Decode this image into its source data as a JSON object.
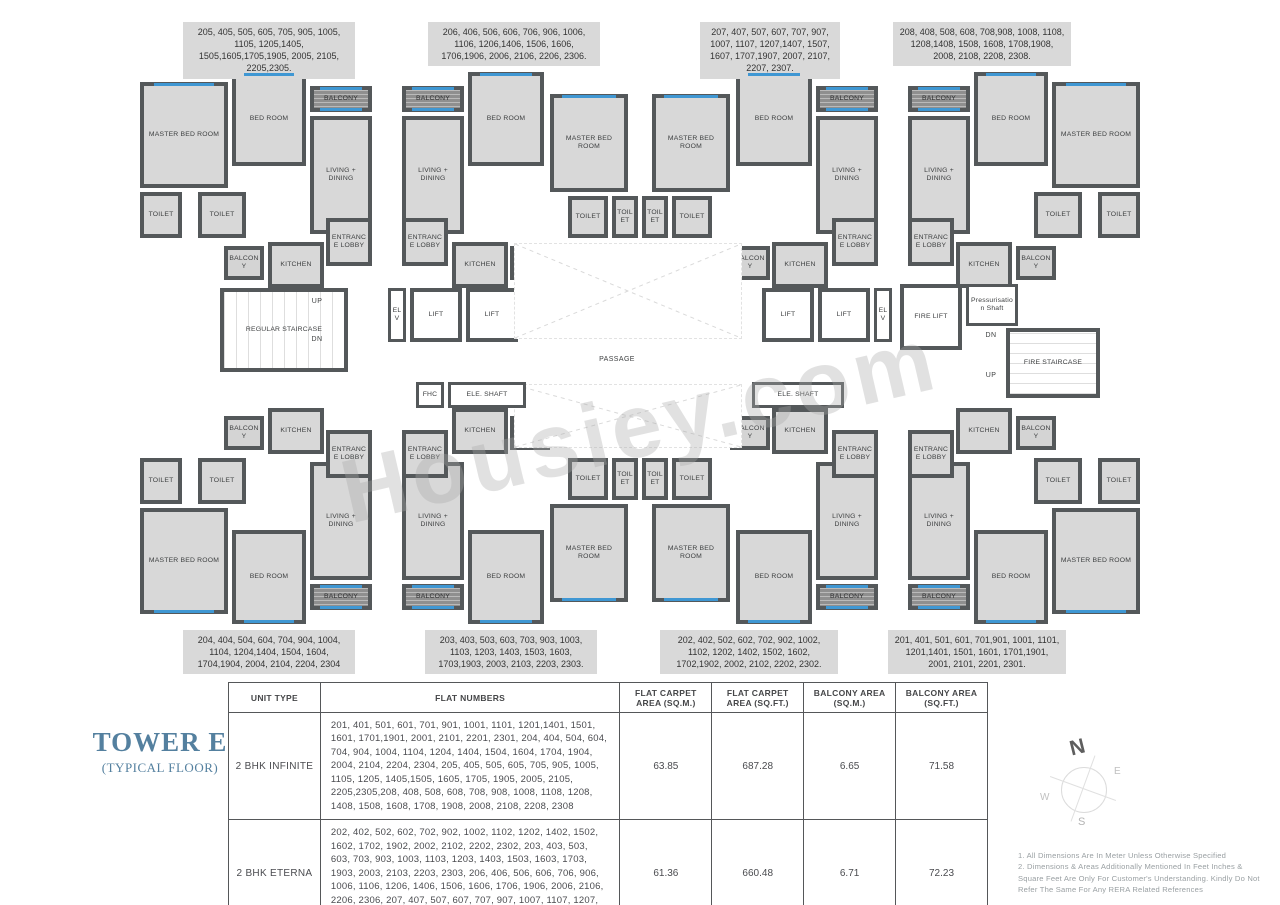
{
  "title": {
    "tower": "TOWER E",
    "floor": "(TYPICAL FLOOR)"
  },
  "watermark": "Housiey.com",
  "flat_labels": {
    "top": [
      "205, 405, 505, 605, 705, 905, 1005, 1105, 1205,1405, 1505,1605,1705,1905, 2005, 2105, 2205,2305.",
      "206, 406, 506, 606, 706, 906, 1006, 1106, 1206,1406, 1506, 1606, 1706,1906, 2006, 2106, 2206, 2306.",
      "207, 407, 507, 607, 707, 907, 1007, 1107, 1207,1407, 1507, 1607, 1707,1907, 2007, 2107, 2207, 2307.",
      "208, 408, 508, 608, 708,908, 1008, 1108, 1208,1408, 1508, 1608, 1708,1908, 2008, 2108, 2208, 2308."
    ],
    "bottom": [
      "204, 404, 504, 604, 704, 904, 1004, 1104, 1204,1404, 1504, 1604, 1704,1904, 2004, 2104, 2204, 2304",
      "203, 403, 503, 603, 703, 903, 1003, 1103, 1203, 1403, 1503, 1603, 1703,1903, 2003, 2103, 2203, 2303.",
      "202, 402, 502, 602, 702, 902, 1002, 1102, 1202, 1402, 1502, 1602, 1702,1902, 2002, 2102, 2202, 2302.",
      "201, 401, 501, 601, 701,901, 1001, 1101, 1201,1401, 1501, 1601, 1701,1901, 2001, 2101, 2201, 2301."
    ]
  },
  "table": {
    "headers": [
      "UNIT TYPE",
      "FLAT NUMBERS",
      "FLAT CARPET AREA (SQ.M.)",
      "FLAT CARPET AREA (SQ.FT.)",
      "BALCONY AREA (SQ.M.)",
      "BALCONY AREA (SQ.FT.)"
    ],
    "rows": [
      {
        "unit_type": "2 BHK INFINITE",
        "flat_numbers": "201, 401, 501, 601, 701, 901, 1001, 1101, 1201,1401, 1501, 1601, 1701,1901, 2001, 2101, 2201, 2301, 204, 404, 504, 604, 704, 904, 1004, 1104, 1204, 1404, 1504, 1604, 1704, 1904, 2004, 2104, 2204, 2304, 205, 405, 505, 605, 705, 905, 1005, 1105, 1205, 1405,1505, 1605, 1705, 1905, 2005, 2105, 2205,2305,208, 408, 508, 608, 708, 908, 1008, 1108, 1208, 1408, 1508, 1608, 1708, 1908, 2008, 2108, 2208, 2308",
        "carpet_sqm": "63.85",
        "carpet_sqft": "687.28",
        "balcony_sqm": "6.65",
        "balcony_sqft": "71.58"
      },
      {
        "unit_type": "2 BHK ETERNA",
        "flat_numbers": "202, 402, 502, 602, 702, 902, 1002, 1102, 1202, 1402, 1502, 1602, 1702, 1902, 2002, 2102, 2202, 2302, 203, 403, 503, 603, 703, 903, 1003, 1103, 1203, 1403, 1503, 1603, 1703, 1903, 2003, 2103, 2203, 2303, 206, 406, 506, 606, 706, 906, 1006, 1106, 1206, 1406, 1506, 1606, 1706, 1906, 2006, 2106, 2206, 2306, 207, 407, 507, 607, 707, 907, 1007, 1107, 1207, 1407, 1507, 1607, 1707, 1907, 2007, 2107, 2207, 2307.",
        "carpet_sqm": "61.36",
        "carpet_sqft": "660.48",
        "balcony_sqm": "6.71",
        "balcony_sqft": "72.23"
      }
    ]
  },
  "notes": [
    "1.  All Dimensions Are In Meter Unless Otherwise Specified",
    "2.  Dimensions & Areas Additionally Mentioned In Feet Inches & Square Feet Are Only For Customer's Understanding. Kindly Do Not Refer The Same For Any RERA Related References"
  ],
  "compass": {
    "n": "N",
    "e": "E",
    "w": "W",
    "s": "S"
  },
  "colors": {
    "wall": "#54585a",
    "room_fill": "#d8d8d8",
    "balcony_fill": "#8f8f8f",
    "window_blue": "#3f97d3",
    "label_box": "#d9d9d9",
    "title_blue": "#54809f"
  },
  "plan": {
    "half_rooms": [
      {
        "t": "room",
        "x": 0,
        "y": 12,
        "w": 88,
        "h": 106,
        "l": "MASTER BED ROOM",
        "win": "top"
      },
      {
        "t": "room",
        "x": 92,
        "y": 2,
        "w": 74,
        "h": 94,
        "l": "BED ROOM",
        "win": "top"
      },
      {
        "t": "balcony",
        "x": 170,
        "y": 16,
        "w": 62,
        "h": 26,
        "l": "BALCONY"
      },
      {
        "t": "room",
        "x": 170,
        "y": 46,
        "w": 62,
        "h": 118,
        "l": "LIVING + DINING"
      },
      {
        "t": "room",
        "x": 0,
        "y": 122,
        "w": 42,
        "h": 46,
        "l": "TOILET"
      },
      {
        "t": "room",
        "x": 58,
        "y": 122,
        "w": 48,
        "h": 46,
        "l": "TOILET"
      },
      {
        "t": "balcony2",
        "x": 84,
        "y": 176,
        "w": 40,
        "h": 34,
        "l": "BALCONY"
      },
      {
        "t": "room",
        "x": 128,
        "y": 172,
        "w": 56,
        "h": 46,
        "l": "KITCHEN"
      },
      {
        "t": "room",
        "x": 186,
        "y": 148,
        "w": 46,
        "h": 48,
        "l": "ENTRANCE LOBBY"
      },
      {
        "t": "balcony",
        "x": 262,
        "y": 16,
        "w": 62,
        "h": 26,
        "l": "BALCONY"
      },
      {
        "t": "room",
        "x": 262,
        "y": 46,
        "w": 62,
        "h": 118,
        "l": "LIVING + DINING"
      },
      {
        "t": "room",
        "x": 262,
        "y": 148,
        "w": 46,
        "h": 48,
        "l": "ENTRANCE LOBBY"
      },
      {
        "t": "room",
        "x": 312,
        "y": 172,
        "w": 56,
        "h": 46,
        "l": "KITCHEN"
      },
      {
        "t": "balcony2",
        "x": 370,
        "y": 176,
        "w": 40,
        "h": 34,
        "l": "BALCONY"
      },
      {
        "t": "room",
        "x": 328,
        "y": 2,
        "w": 76,
        "h": 94,
        "l": "BED ROOM",
        "win": "top"
      },
      {
        "t": "room",
        "x": 410,
        "y": 24,
        "w": 78,
        "h": 98,
        "l": "MASTER BED ROOM",
        "win": "top"
      },
      {
        "t": "room",
        "x": 428,
        "y": 126,
        "w": 40,
        "h": 42,
        "l": "TOILET"
      },
      {
        "t": "room",
        "x": 472,
        "y": 126,
        "w": 26,
        "h": 42,
        "l": "TOILET"
      },
      {
        "t": "balcony",
        "x": 676,
        "y": 16,
        "w": 62,
        "h": 26,
        "l": "BALCONY"
      },
      {
        "t": "room",
        "x": 676,
        "y": 46,
        "w": 62,
        "h": 118,
        "l": "LIVING + DINING"
      },
      {
        "t": "room",
        "x": 692,
        "y": 148,
        "w": 46,
        "h": 48,
        "l": "ENTRANCE LOBBY"
      },
      {
        "t": "room",
        "x": 632,
        "y": 172,
        "w": 56,
        "h": 46,
        "l": "KITCHEN"
      },
      {
        "t": "balcony2",
        "x": 590,
        "y": 176,
        "w": 40,
        "h": 34,
        "l": "BALCONY"
      },
      {
        "t": "room",
        "x": 596,
        "y": 2,
        "w": 76,
        "h": 94,
        "l": "BED ROOM",
        "win": "top"
      },
      {
        "t": "room",
        "x": 512,
        "y": 24,
        "w": 78,
        "h": 98,
        "l": "MASTER BED ROOM",
        "win": "top"
      },
      {
        "t": "room",
        "x": 532,
        "y": 126,
        "w": 40,
        "h": 42,
        "l": "TOILET"
      },
      {
        "t": "room",
        "x": 502,
        "y": 126,
        "w": 26,
        "h": 42,
        "l": "TOILET"
      },
      {
        "t": "room",
        "x": 912,
        "y": 12,
        "w": 88,
        "h": 106,
        "l": "MASTER BED ROOM",
        "win": "top"
      },
      {
        "t": "room",
        "x": 834,
        "y": 2,
        "w": 74,
        "h": 94,
        "l": "BED ROOM",
        "win": "top"
      },
      {
        "t": "balcony",
        "x": 768,
        "y": 16,
        "w": 62,
        "h": 26,
        "l": "BALCONY"
      },
      {
        "t": "room",
        "x": 768,
        "y": 46,
        "w": 62,
        "h": 118,
        "l": "LIVING + DINING"
      },
      {
        "t": "room",
        "x": 958,
        "y": 122,
        "w": 42,
        "h": 46,
        "l": "TOILET"
      },
      {
        "t": "room",
        "x": 894,
        "y": 122,
        "w": 48,
        "h": 46,
        "l": "TOILET"
      },
      {
        "t": "balcony2",
        "x": 876,
        "y": 176,
        "w": 40,
        "h": 34,
        "l": "BALCONY"
      },
      {
        "t": "room",
        "x": 816,
        "y": 172,
        "w": 56,
        "h": 46,
        "l": "KITCHEN"
      },
      {
        "t": "room",
        "x": 768,
        "y": 148,
        "w": 46,
        "h": 48,
        "l": "ENTRANCE LOBBY"
      }
    ],
    "core_rooms": [
      {
        "t": "stairv",
        "x": 80,
        "y": 218,
        "w": 128,
        "h": 84,
        "l": "REGULAR STAIRCASE"
      },
      {
        "t": "shaft",
        "x": 248,
        "y": 218,
        "w": 18,
        "h": 54,
        "l": "ELV"
      },
      {
        "t": "lift",
        "x": 270,
        "y": 218,
        "w": 52,
        "h": 54,
        "l": "LIFT"
      },
      {
        "t": "lift",
        "x": 326,
        "y": 218,
        "w": 52,
        "h": 54,
        "l": "LIFT"
      },
      {
        "t": "lift",
        "x": 622,
        "y": 218,
        "w": 52,
        "h": 54,
        "l": "LIFT"
      },
      {
        "t": "lift",
        "x": 678,
        "y": 218,
        "w": 52,
        "h": 54,
        "l": "LIFT"
      },
      {
        "t": "shaft",
        "x": 734,
        "y": 218,
        "w": 18,
        "h": 54,
        "l": "ELV"
      },
      {
        "t": "lift",
        "x": 760,
        "y": 214,
        "w": 62,
        "h": 66,
        "l": "FIRE LIFT"
      },
      {
        "t": "shaft",
        "x": 826,
        "y": 214,
        "w": 52,
        "h": 42,
        "l": "Pressurisation Shaft"
      },
      {
        "t": "stairh",
        "x": 866,
        "y": 258,
        "w": 94,
        "h": 70,
        "l": "FIRE STAIRCASE"
      },
      {
        "t": "void",
        "x": 374,
        "y": 173,
        "w": 228,
        "h": 96
      },
      {
        "t": "void",
        "x": 374,
        "y": 314,
        "w": 228,
        "h": 64
      },
      {
        "t": "shaft",
        "x": 276,
        "y": 312,
        "w": 28,
        "h": 26,
        "l": "FHC"
      },
      {
        "t": "shaft",
        "x": 308,
        "y": 312,
        "w": 78,
        "h": 26,
        "l": "ELE. SHAFT"
      },
      {
        "t": "shaft",
        "x": 612,
        "y": 312,
        "w": 92,
        "h": 26,
        "l": "ELE. SHAFT"
      }
    ],
    "texts": [
      {
        "x": 160,
        "y": 228,
        "w": 34,
        "h": 12,
        "l": "UP"
      },
      {
        "x": 160,
        "y": 266,
        "w": 34,
        "h": 12,
        "l": "DN"
      },
      {
        "x": 834,
        "y": 262,
        "w": 34,
        "h": 12,
        "l": "DN"
      },
      {
        "x": 834,
        "y": 302,
        "w": 34,
        "h": 12,
        "l": "UP"
      },
      {
        "x": 437,
        "y": 286,
        "w": 80,
        "h": 14,
        "l": "PASSAGE"
      }
    ]
  }
}
